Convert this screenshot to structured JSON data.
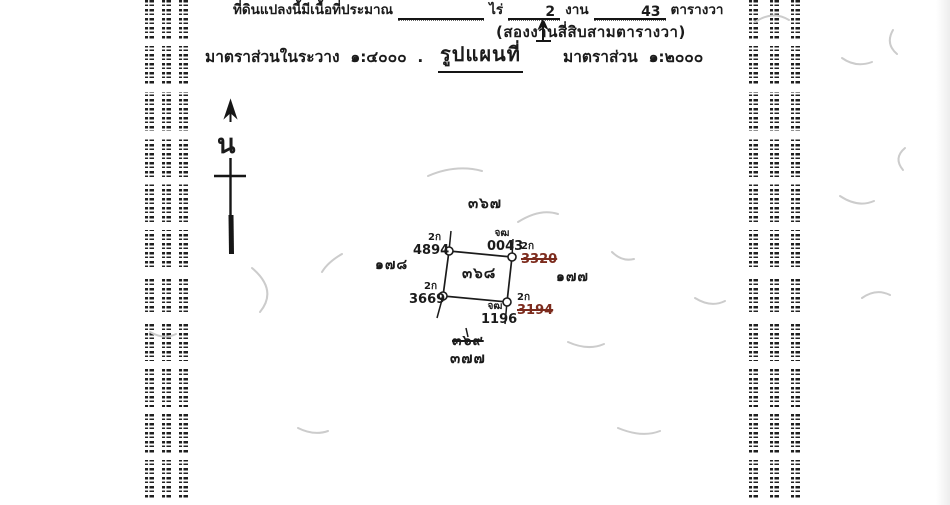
{
  "colors": {
    "ink": "#1b1b1b",
    "strike_ink": "#7c2b1d",
    "squiggle": "#cccccc"
  },
  "header": {
    "area_line": {
      "prefix": "ที่ดินแปลงนี้มีเนื้อที่ประมาณ",
      "rai_value": "",
      "rai_label": "ไร่",
      "ngan_value": "2",
      "ngan_label": "งาน",
      "wa_value": "43",
      "wa_label": "ตารางวา"
    },
    "area_words": "(สองงานสี่สิบสามตารางวา)",
    "sheet_scale_label": "มาตราส่วนในระวาง",
    "sheet_scale_value": "๑:๔๐๐๐",
    "sheet_scale_suffix": ".",
    "map_title": "รูปแผนที่",
    "map_scale_label": "มาตราส่วน",
    "map_scale_value": "๑:๒๐๐๐"
  },
  "north_arrow": {
    "letter": "น"
  },
  "plot": {
    "parcel_no": "๓๖๘",
    "adjacent": {
      "north": "๓๖๗",
      "west": "๑๗๘",
      "east": "๑๗๗",
      "south_old": "๓๖๙",
      "south": "๓๗๗"
    },
    "markers": {
      "top_left": {
        "code": "2ก",
        "number": "4894"
      },
      "top_right_boundary": {
        "code": "จฒ",
        "number": "0043"
      },
      "top_right_old": {
        "code": "2ก",
        "number": "3320"
      },
      "bottom_left": {
        "code": "2ก",
        "number": "3669"
      },
      "bottom_right_boundary": {
        "code": "จฒ",
        "number": "1196"
      },
      "bottom_right_old": {
        "code": "2ก",
        "number": "3194"
      }
    }
  }
}
